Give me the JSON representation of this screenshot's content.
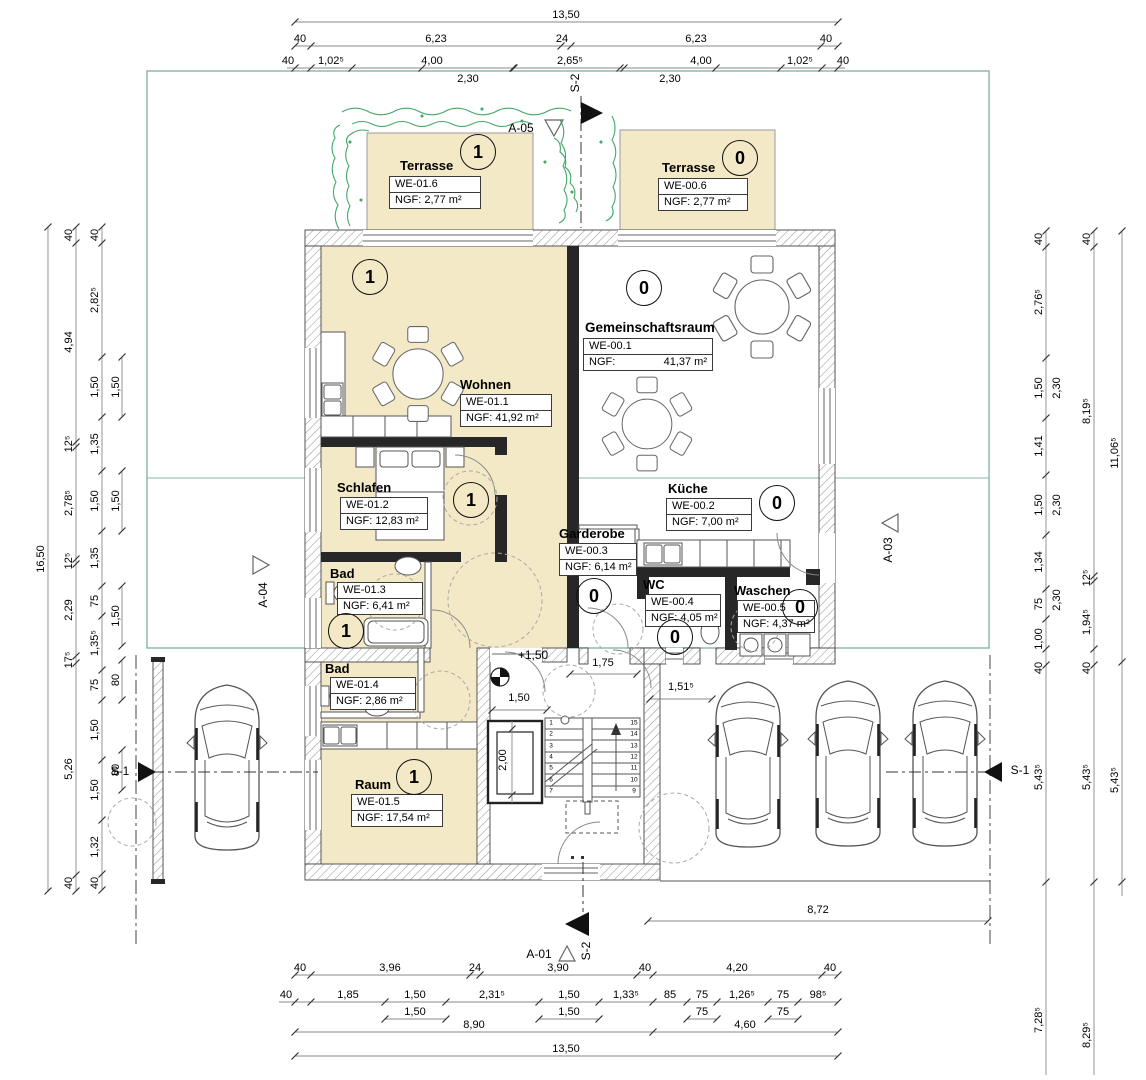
{
  "rooms": {
    "terrasse1": {
      "name": "Terrasse",
      "unit": "1",
      "we": "WE-01.6",
      "ngf": "NGF: 2,77 m²"
    },
    "terrasse0": {
      "name": "Terrasse",
      "unit": "0",
      "we": "WE-00.6",
      "ngf": "NGF: 2,77 m²"
    },
    "wohnen": {
      "name": "Wohnen",
      "unit": "1",
      "we": "WE-01.1",
      "ngf": "NGF: 41,92 m²"
    },
    "gemeinschaftsraum": {
      "name": "Gemeinschaftsraum",
      "unit": "0",
      "we": "WE-00.1",
      "ngf_label": "NGF:",
      "ngf_value": "41,37 m²"
    },
    "schlafen": {
      "name": "Schlafen",
      "unit": "1",
      "we": "WE-01.2",
      "ngf": "NGF: 12,83 m²"
    },
    "kueche": {
      "name": "Küche",
      "unit": "0",
      "we": "WE-00.2",
      "ngf": "NGF: 7,00 m²"
    },
    "garderobe": {
      "name": "Garderobe",
      "unit": "0",
      "we": "WE-00.3",
      "ngf": "NGF: 6,14 m²"
    },
    "bad1": {
      "name": "Bad",
      "unit": "1",
      "we": "WE-01.3",
      "ngf": "NGF: 6,41 m²"
    },
    "wc": {
      "name": "WC",
      "unit": "0",
      "we": "WE-00.4",
      "ngf": "NGF: 4,05 m²"
    },
    "waschen": {
      "name": "Waschen",
      "unit": "0",
      "we": "WE-00.5",
      "ngf": "NGF: 4,37 m²"
    },
    "bad2": {
      "name": "Bad",
      "we": "WE-01.4",
      "ngf": "NGF: 2,86 m²"
    },
    "raum": {
      "name": "Raum",
      "unit": "1",
      "we": "WE-01.5",
      "ngf": "NGF: 17,54 m²"
    }
  },
  "markers": {
    "s2": "S-2",
    "s1": "S-1",
    "a01": "A-01",
    "a03": "A-03",
    "a04": "A-04",
    "a05": "A-05",
    "level": "+1,50"
  },
  "stairs": {
    "left": [
      "1",
      "2",
      "3",
      "4",
      "5",
      "6",
      "7"
    ],
    "right": [
      "15",
      "14",
      "13",
      "12",
      "11",
      "10",
      "9"
    ]
  },
  "dims": {
    "top_total": "13,50",
    "top_row2": [
      "40",
      "6,23",
      "24",
      "6,23",
      "40"
    ],
    "top_row3": [
      "40",
      "1,02⁵",
      "4,00",
      "2,65⁵",
      "4,00",
      "1,02⁵",
      "40"
    ],
    "top_row4": [
      "2,30",
      "2,30"
    ],
    "bottom_row1": [
      "40",
      "3,96",
      "24",
      "3,90",
      "40",
      "4,20",
      "40"
    ],
    "bottom_row2": [
      "40",
      "1,85",
      "1,50",
      "2,31⁵",
      "1,50",
      "1,33⁵",
      "85",
      "75",
      "1,26⁵",
      "75",
      "98⁵"
    ],
    "bottom_row2b": [
      "1,50",
      "1,50",
      "75",
      "75"
    ],
    "bottom_row3": [
      "8,90",
      "4,60"
    ],
    "bottom_total": "13,50",
    "parking_width": "8,72",
    "left_total": "16,50",
    "left_b": [
      "40",
      "4,94",
      "12⁵",
      "2,78⁵",
      "12⁵",
      "2,29",
      "17⁵",
      "5,26",
      "40"
    ],
    "left_c": [
      "40",
      "2,82⁵",
      "1,50",
      "1,35",
      "1,50",
      "1,35",
      "75",
      "1,35⁵",
      "75",
      "1,50",
      "1,50",
      "1,32",
      "40"
    ],
    "left_d": [
      "1,50",
      "1,50",
      "1,50",
      "80",
      "80"
    ],
    "right_r1": [
      "40",
      "2,76⁵",
      "1,50",
      "1,41",
      "1,50",
      "1,34",
      "75",
      "1,00",
      "40",
      "5,43⁵",
      "7,28⁵"
    ],
    "right_sub": [
      "2,30",
      "2,30",
      "2,30"
    ],
    "right_r2": [
      "40",
      "8,19⁵",
      "12⁵",
      "1,94⁵",
      "40",
      "5,43⁵",
      "8,29⁵"
    ],
    "right_r3": [
      "11,06⁵",
      "5,43⁵"
    ],
    "inner": {
      "entry_d1": "1,50",
      "entry_d2": "1,75",
      "parking_gap": "1,51⁵",
      "elevator": "2,00"
    }
  },
  "colors": {
    "apartment_fill": "#f3e9c6",
    "boundary_green": "#84b8a4",
    "vegetation_green": "#2f9e57",
    "wall_black": "#272727"
  }
}
